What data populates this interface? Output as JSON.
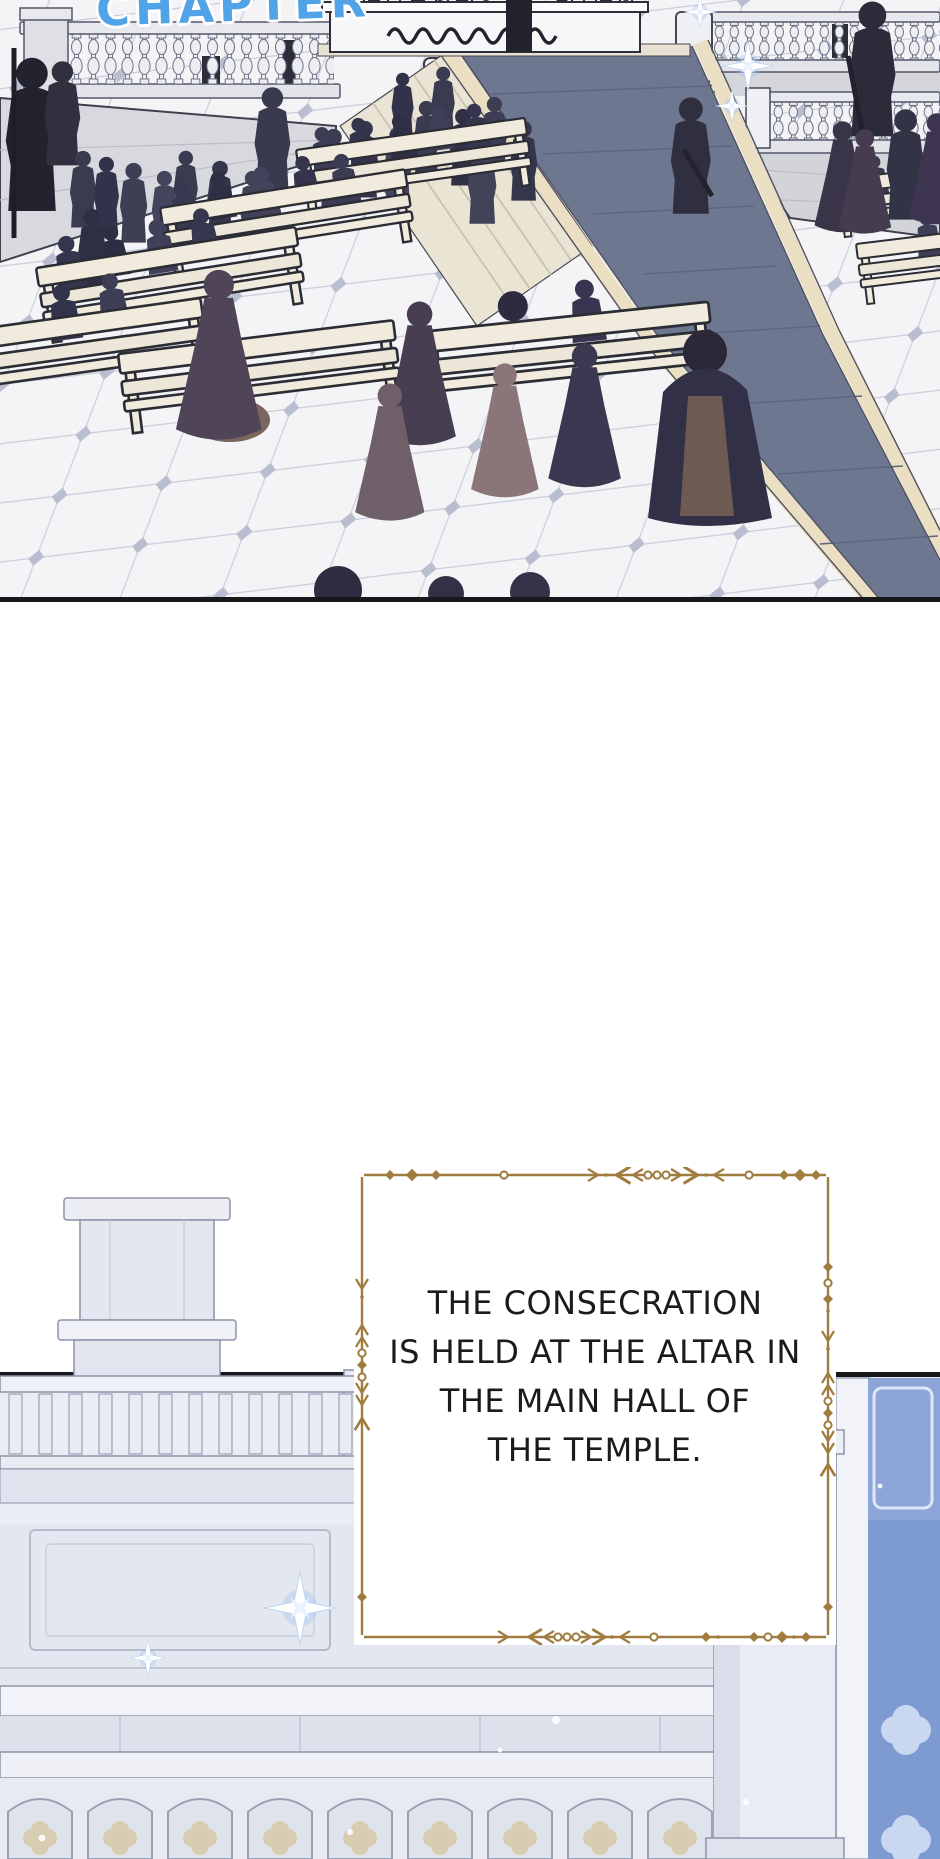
{
  "page": {
    "width": 940,
    "height": 1859,
    "background": "#ffffff"
  },
  "header": {
    "chapter_label": "CHAPTER",
    "chapter_label_color": "#4fa3e6"
  },
  "narration_box": {
    "lines": [
      "THE CONSECRATION",
      "IS HELD AT THE ALTAR IN",
      "THE MAIN HALL OF",
      "THE TEMPLE."
    ],
    "text_color": "#1b1b1f",
    "border_color": "#a07c3e",
    "background_color": "#ffffff"
  },
  "panels": [
    {
      "id": "plaza-ceremony",
      "border_color": "#17171c"
    },
    {
      "id": "temple-main-hall",
      "border_color": "#17171c"
    }
  ],
  "palette": {
    "carpet_blue_gray": "#6d7790",
    "carpet_trim_cream": "#eadfc2",
    "stone_wall": "#d8d9df",
    "steps_cream": "#e9e4d4",
    "bench_cream": "#f0ebdd",
    "crowd_silhouette": "#3a3a50",
    "tile_floor": "#f4f4f7",
    "temple_wall": "#e6e9f1",
    "stained_glass_blue": "#7d9bd0",
    "quatrefoil_beige": "#d8cdb2",
    "sparkle_blue": "#9fc0f0"
  }
}
